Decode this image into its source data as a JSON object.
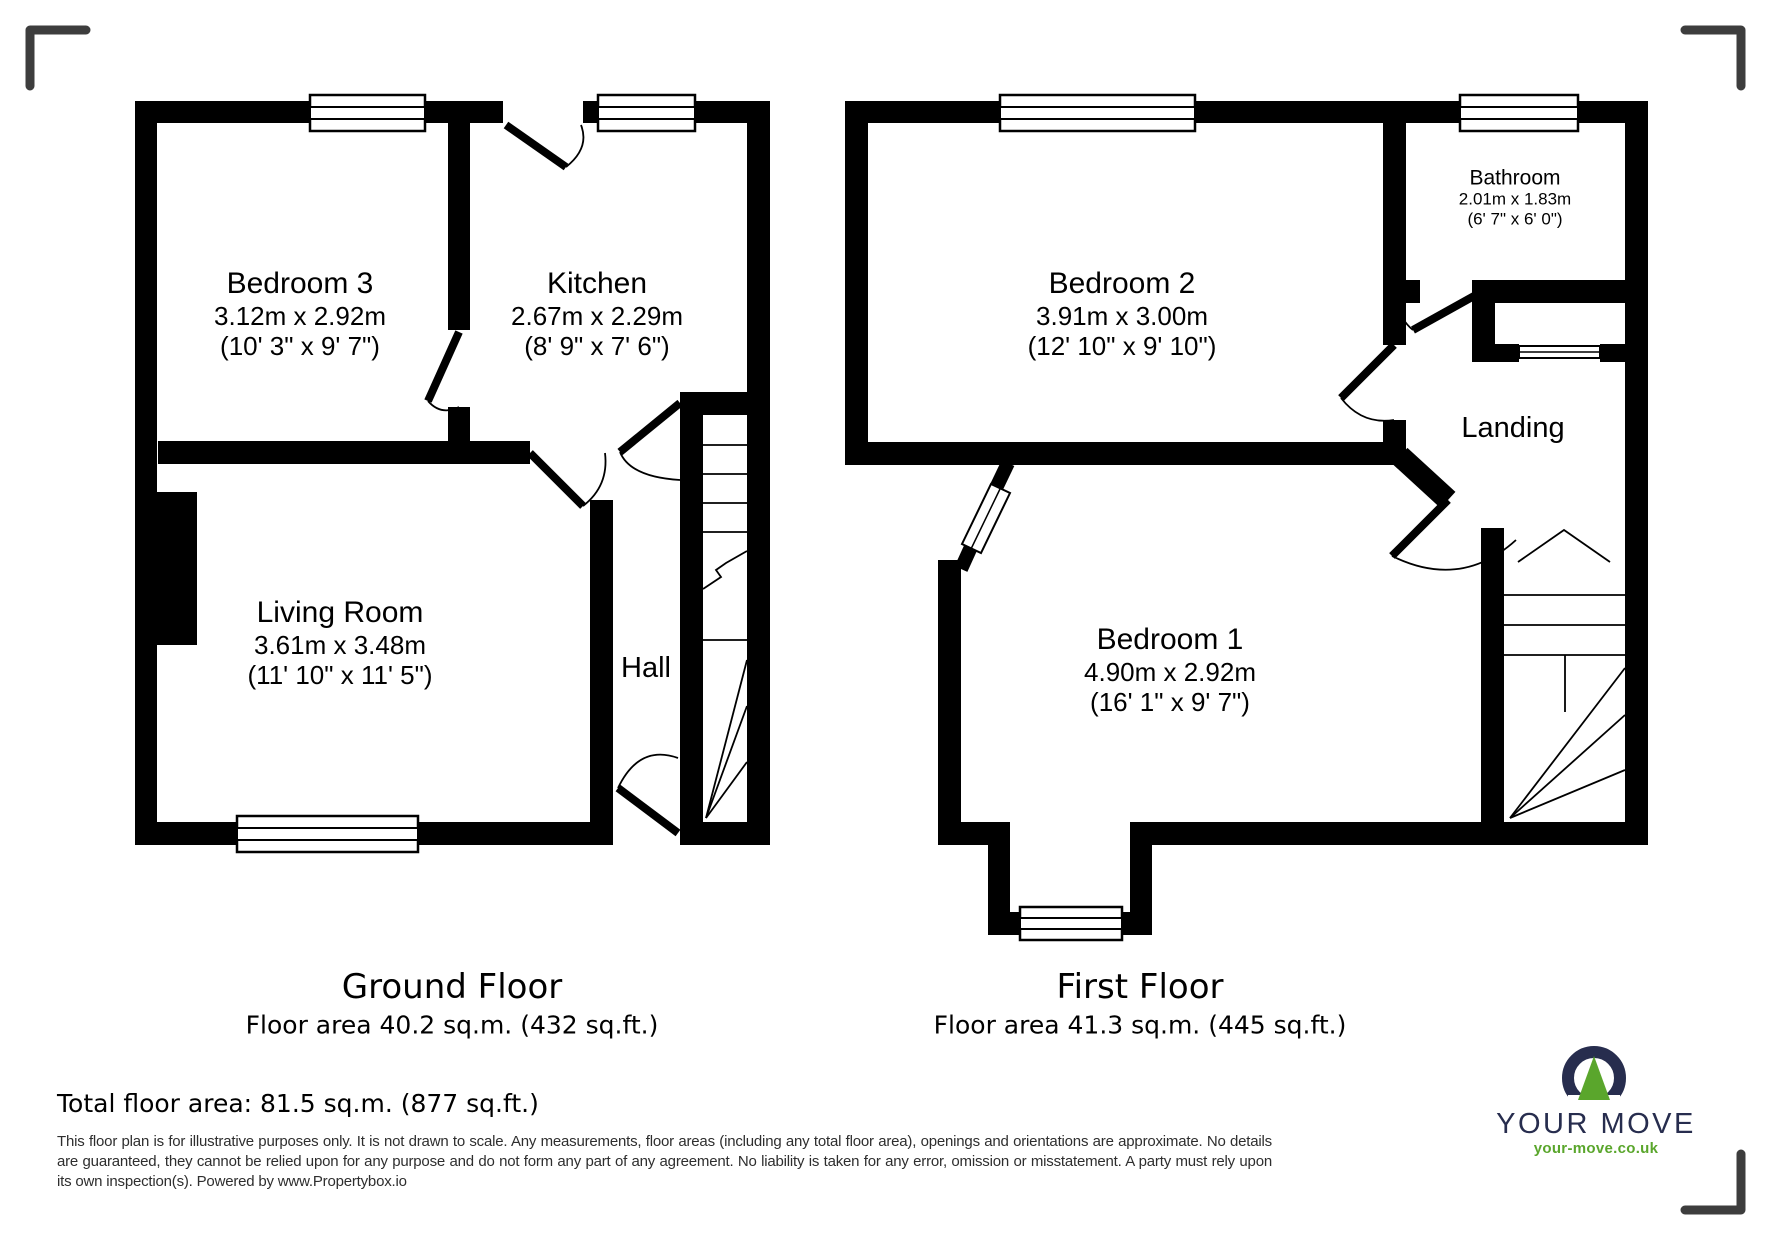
{
  "ground_floor": {
    "title": "Ground Floor",
    "area_label": "Floor area 40.2 sq.m. (432 sq.ft.)",
    "rooms": [
      {
        "name": "Bedroom 3",
        "dims_m": "3.12m x 2.92m",
        "dims_ft": "(10' 3\" x 9' 7\")"
      },
      {
        "name": "Kitchen",
        "dims_m": "2.67m x 2.29m",
        "dims_ft": "(8' 9\" x 7' 6\")"
      },
      {
        "name": "Living Room",
        "dims_m": "3.61m x 3.48m",
        "dims_ft": "(11' 10\" x 11' 5\")"
      },
      {
        "name": "Hall"
      }
    ]
  },
  "first_floor": {
    "title": "First Floor",
    "area_label": "Floor area 41.3 sq.m. (445 sq.ft.)",
    "rooms": [
      {
        "name": "Bedroom 2",
        "dims_m": "3.91m x 3.00m",
        "dims_ft": "(12' 10\" x 9' 10\")"
      },
      {
        "name": "Bathroom",
        "dims_m": "2.01m x 1.83m",
        "dims_ft": "(6' 7\" x 6' 0\")"
      },
      {
        "name": "Bedroom 1",
        "dims_m": "4.90m x 2.92m",
        "dims_ft": "(16' 1\" x 9' 7\")"
      },
      {
        "name": "Landing"
      }
    ]
  },
  "total_area": "Total floor area: 81.5 sq.m. (877 sq.ft.)",
  "disclaimer": "This floor plan is for illustrative purposes only. It is not drawn to scale. Any measurements, floor areas (including any total floor area), openings and orientations are approximate. No details are guaranteed, they cannot be relied upon for any purpose and do not form any part of any agreement. No liability is taken for any error, omission or misstatement. A party must rely upon its own inspection(s). Powered by www.Propertybox.io",
  "branding": {
    "name": "YOUR MOVE",
    "website": "your-move.co.uk",
    "navy": "#272d4e",
    "green": "#5aa62c"
  },
  "colors": {
    "wall": "#000000",
    "corner_mark": "#3d3d3d",
    "background": "#ffffff"
  }
}
